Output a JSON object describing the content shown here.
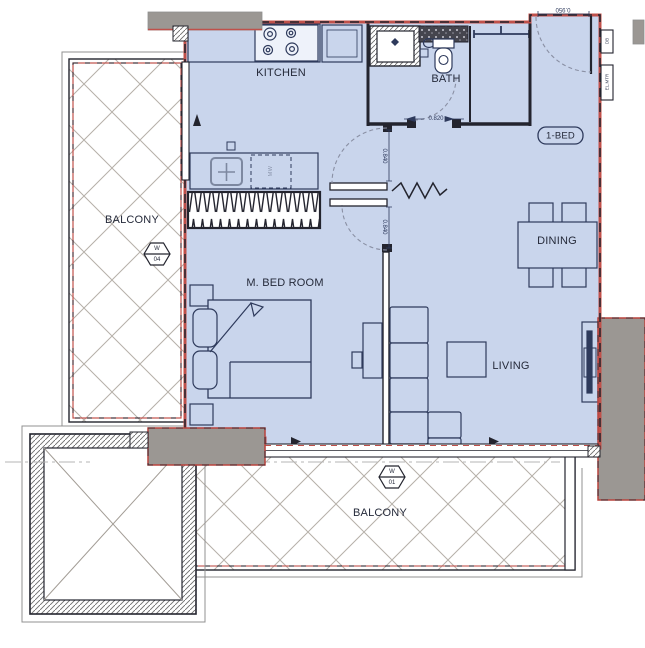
{
  "title": "1-BED unit floor plan",
  "unit_tag": "1-BED",
  "rooms": {
    "kitchen": "KITCHEN",
    "bath": "BATH",
    "dining": "DINING",
    "living": "LIVING",
    "bedroom": "M. BED ROOM",
    "balcony_left": "BALCONY",
    "balcony_bottom": "BALCONY"
  },
  "window_tags": {
    "left": {
      "line1": "W",
      "line2": "04"
    },
    "bottom": {
      "line1": "W",
      "line2": "01"
    }
  },
  "dimensions": {
    "entrance_door": "0.950",
    "hall_door": "0.840",
    "bedroom_door": "0.840",
    "bath_door": "0.820"
  },
  "appliances": {
    "microwave": "MW"
  },
  "panels": {
    "distribution_board": "DB",
    "electric_meter": "EL.MTR"
  },
  "colors": {
    "floor_fill": "#c9d5ec",
    "wall_accent_red": "#c0504a",
    "column_gray": "#9b9793",
    "line_navy": "#2e3a5c",
    "wall_black": "#23242e"
  }
}
